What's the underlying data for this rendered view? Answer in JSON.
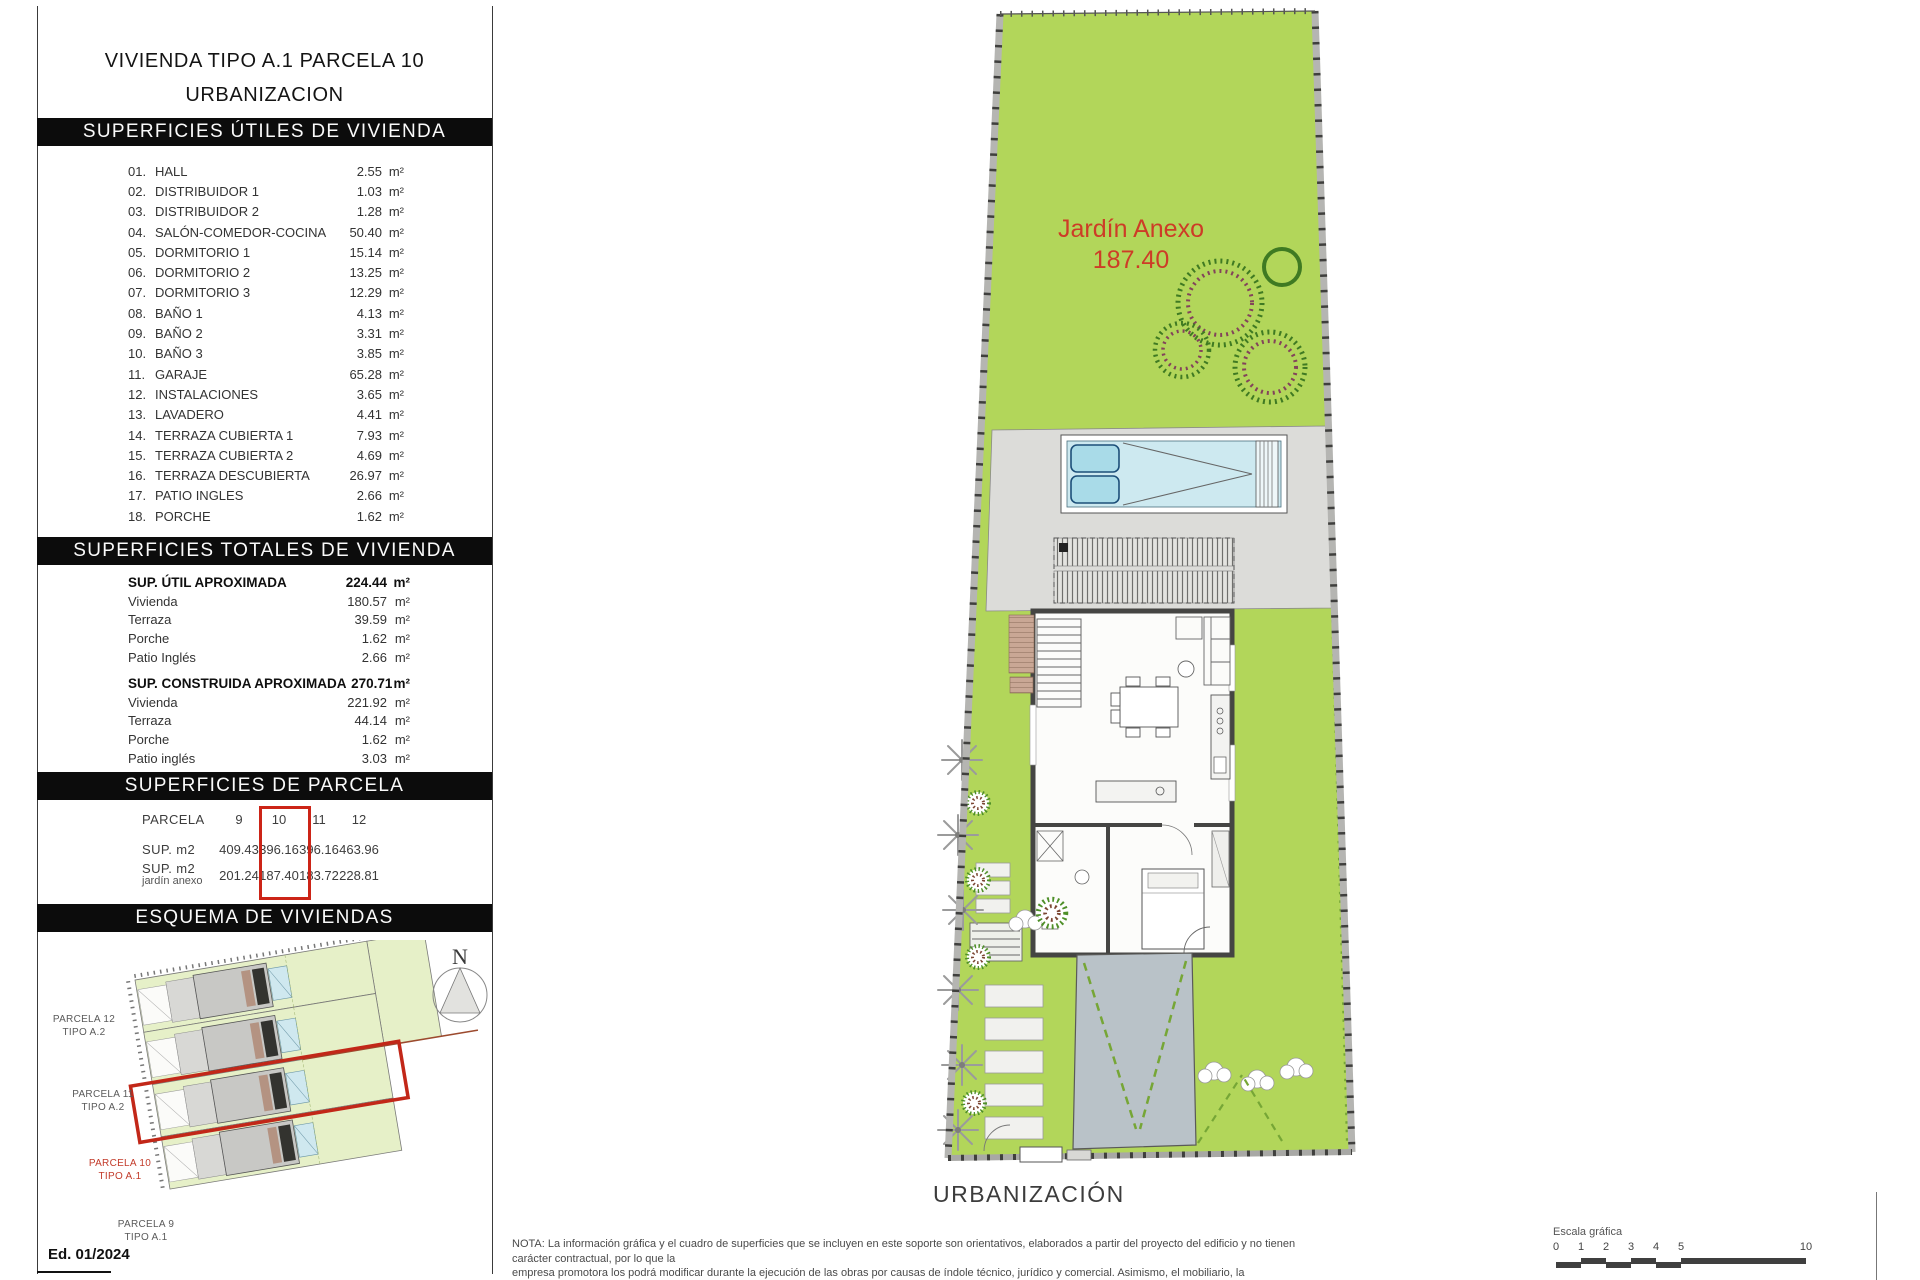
{
  "units": {
    "m2": "m²"
  },
  "edition": "Ed. 01/2024",
  "sidebar": {
    "title_line1": "VIVIENDA TIPO A.1 PARCELA 10",
    "title_line2": "URBANIZACION",
    "utiles": {
      "heading": "SUPERFICIES ÚTILES DE VIVIENDA",
      "rows": [
        {
          "num": "01.",
          "label": "HALL",
          "value": "2.55"
        },
        {
          "num": "02.",
          "label": "DISTRIBUIDOR 1",
          "value": "1.03"
        },
        {
          "num": "03.",
          "label": "DISTRIBUIDOR 2",
          "value": "1.28"
        },
        {
          "num": "04.",
          "label": "SALÓN-COMEDOR-COCINA",
          "value": "50.40"
        },
        {
          "num": "05.",
          "label": "DORMITORIO 1",
          "value": "15.14"
        },
        {
          "num": "06.",
          "label": "DORMITORIO 2",
          "value": "13.25"
        },
        {
          "num": "07.",
          "label": "DORMITORIO 3",
          "value": "12.29"
        },
        {
          "num": "08.",
          "label": "BAÑO 1",
          "value": "4.13"
        },
        {
          "num": "09.",
          "label": "BAÑO 2",
          "value": "3.31"
        },
        {
          "num": "10.",
          "label": "BAÑO 3",
          "value": "3.85"
        },
        {
          "num": "11.",
          "label": "GARAJE",
          "value": "65.28"
        },
        {
          "num": "12.",
          "label": "INSTALACIONES",
          "value": "3.65"
        },
        {
          "num": "13.",
          "label": "LAVADERO",
          "value": "4.41"
        },
        {
          "num": "14.",
          "label": "TERRAZA CUBIERTA 1",
          "value": "7.93"
        },
        {
          "num": "15.",
          "label": "TERRAZA CUBIERTA 2",
          "value": "4.69"
        },
        {
          "num": "16.",
          "label": "TERRAZA DESCUBIERTA",
          "value": "26.97"
        },
        {
          "num": "17.",
          "label": "PATIO INGLES",
          "value": "2.66"
        },
        {
          "num": "18.",
          "label": "PORCHE",
          "value": "1.62"
        }
      ]
    },
    "totales": {
      "heading": "SUPERFICIES TOTALES DE VIVIENDA",
      "util": {
        "label": "SUP. ÚTIL APROXIMADA",
        "value": "224.44",
        "rows": [
          {
            "label": "Vivienda",
            "value": "180.57"
          },
          {
            "label": "Terraza",
            "value": "39.59"
          },
          {
            "label": "Porche",
            "value": "1.62"
          },
          {
            "label": "Patio Inglés",
            "value": "2.66"
          }
        ]
      },
      "construida": {
        "label": "SUP. CONSTRUIDA APROXIMADA",
        "value": "270.71",
        "rows": [
          {
            "label": "Vivienda",
            "value": "221.92"
          },
          {
            "label": "Terraza",
            "value": "44.14"
          },
          {
            "label": "Porche",
            "value": "1.62"
          },
          {
            "label": "Patio inglés",
            "value": "3.03"
          }
        ]
      }
    },
    "parcela": {
      "heading": "SUPERFICIES DE PARCELA",
      "row1_label": "PARCELA",
      "row2_label": "SUP. m2",
      "row3_label": "SUP. m2",
      "row3_sublabel": "jardín anexo",
      "highlighted": "10",
      "columns": [
        {
          "id": "9",
          "sup": "409.43",
          "jardin": "201.24"
        },
        {
          "id": "10",
          "sup": "396.16",
          "jardin": "187.40"
        },
        {
          "id": "11",
          "sup": "396.16",
          "jardin": "183.72"
        },
        {
          "id": "12",
          "sup": "463.96",
          "jardin": "228.81"
        }
      ]
    },
    "esquema": {
      "heading": "ESQUEMA DE VIVIENDAS",
      "north": "N",
      "labels": [
        {
          "line1": "PARCELA 12",
          "line2": "TIPO A.2"
        },
        {
          "line1": "PARCELA 11",
          "line2": "TIPO A.2"
        },
        {
          "line1": "PARCELA 10",
          "line2": "TIPO A.1"
        },
        {
          "line1": "PARCELA 9",
          "line2": "TIPO A.1"
        }
      ]
    }
  },
  "plan": {
    "garden_label": "Jardín Anexo",
    "garden_area": "187.40",
    "caption": "URBANIZACIÓN"
  },
  "footer": {
    "nota_lines": [
      "NOTA: La información gráfica y el cuadro de superficies que se incluyen en este soporte son orientativos, elaborados a partir del proyecto del edificio y no tienen carácter contractual, por lo que la",
      "empresa promotora los podrá modificar durante la ejecución de las obras por causas de índole técnico, jurídico y comercial. Asimismo, el mobiliario, la decoracion, los elementos de ambientacion y los",
      "electrodomesticos incluidos son de caracter decorativo y no son objeto de contratación."
    ],
    "scale": {
      "label": "Escala gráfica",
      "ticks": [
        "0",
        "1",
        "2",
        "3",
        "4",
        "5",
        "10"
      ]
    }
  },
  "colors": {
    "garden_green": "#b2d65a",
    "pale_green": "#e6f0c8",
    "terrace_gray": "#dcdcd9",
    "pool_blue": "#cde9f0",
    "driveway_gray": "#b9c2c8",
    "accent_red": "#cc2417",
    "banner_black": "#0c0c0c"
  }
}
